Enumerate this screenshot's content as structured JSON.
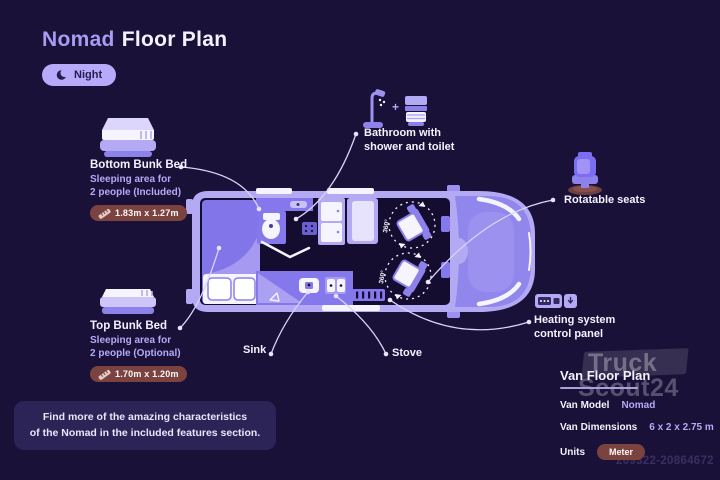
{
  "title": {
    "highlight": "Nomad",
    "rest": "Floor Plan"
  },
  "mode_badge": {
    "label": "Night"
  },
  "features": {
    "bottom_bunk": {
      "title": "Bottom Bunk Bed",
      "line1": "Sleeping area for",
      "line2": "2 people (Included)",
      "dimensions": "1.83m x 1.27m"
    },
    "top_bunk": {
      "title": "Top Bunk Bed",
      "line1": "Sleeping area for",
      "line2": "2 people (Optional)",
      "dimensions": "1.70m x 1.20m"
    },
    "bathroom": {
      "line1": "Bathroom with",
      "line2": "shower and toilet"
    },
    "rotatable_seats": {
      "label": "Rotatable seats"
    },
    "heating": {
      "line1": "Heating system",
      "line2": "control panel"
    },
    "sink": {
      "label": "Sink"
    },
    "stove": {
      "label": "Stove"
    }
  },
  "floor_plan": {
    "seat_rotation": "360°"
  },
  "info_box": {
    "line1": "Find more of the amazing characteristics",
    "line2": "of the Nomad in the included features section."
  },
  "spec_panel": {
    "heading": "Van Floor Plan",
    "rows": [
      {
        "label": "Van Model",
        "value": "Nomad"
      },
      {
        "label": "Van Dimensions",
        "value": "6 x 2 x 2.75 m"
      },
      {
        "label": "Units",
        "value": "Meter"
      }
    ]
  },
  "watermark": {
    "line1": "Truck",
    "line2": "Scout24",
    "id": "209322-20864672"
  },
  "icons": {
    "mode": "moon-icon",
    "bottom_bunk": "bunk-bed-icon",
    "top_bunk": "bunk-bed-icon",
    "bathroom": [
      "shower-icon",
      "toilet-icon"
    ],
    "rotatable_seats": "swivel-seat-icon",
    "heating": "control-panel-icon",
    "dimensions": "ruler-icon"
  },
  "colors": {
    "background": "#1a1139",
    "accent_lavender": "#b5aaf6",
    "van_body": "#b4aaf3",
    "furniture_purple": "#8478ec",
    "interior_dark": "#140d30",
    "badge_maroon": "#7b4340",
    "night_badge": "#b7aafa",
    "text_white": "#f4f2fe"
  }
}
